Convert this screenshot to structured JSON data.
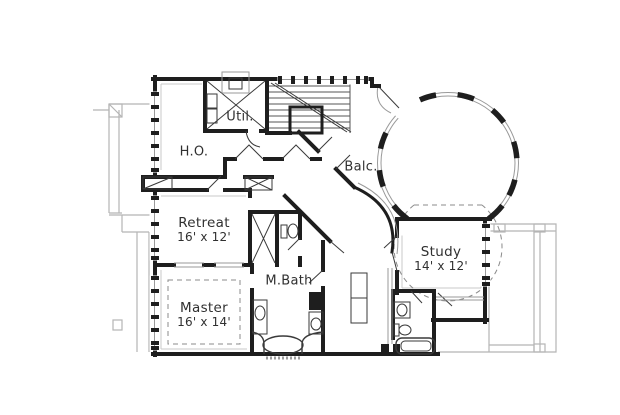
{
  "rooms": {
    "util": {
      "label": "Util."
    },
    "ho": {
      "label": "H.O."
    },
    "balc": {
      "label": "Balc."
    },
    "retreat": {
      "label": "Retreat",
      "dims": "16' x 12'"
    },
    "master": {
      "label": "Master",
      "dims": "16' x 14'"
    },
    "mbath": {
      "label": "M.Bath"
    },
    "study": {
      "label": "Study",
      "dims": "14' x 12'"
    }
  },
  "colors": {
    "wall": "#1e1e1e",
    "roofline": "#b5b5b5",
    "text": "#303030",
    "background": "#ffffff"
  }
}
